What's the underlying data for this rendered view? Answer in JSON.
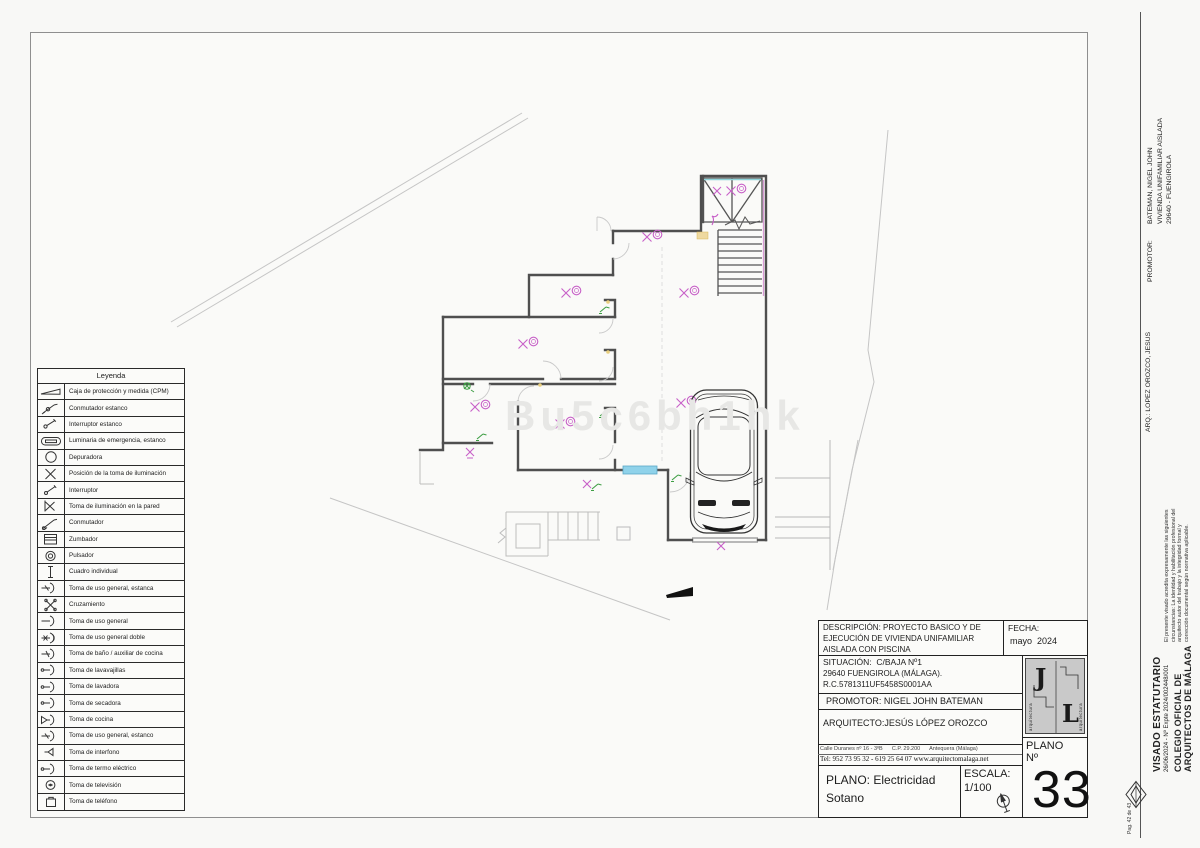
{
  "colors": {
    "wall": "#4f4f4f",
    "magenta": "#c75fc7",
    "green": "#3f9f45",
    "yellow": "#e9cf7e",
    "cyan": "#8fd2ea",
    "site": "#c2c2c2"
  },
  "watermark": "Bu5c6bh1hk",
  "legend": {
    "title": "Leyenda",
    "items": [
      {
        "icon": "cpm-wedge-icon",
        "label": "Caja de protección y medida (CPM)"
      },
      {
        "icon": "conmutador-estanco-icon",
        "label": "Conmutador estanco"
      },
      {
        "icon": "interruptor-estanco-icon",
        "label": "Interruptor estanco"
      },
      {
        "icon": "luminaria-emergencia-icon",
        "label": "Luminaria de emergencia, estanco"
      },
      {
        "icon": "depuradora-icon",
        "label": "Depuradora"
      },
      {
        "icon": "toma-iluminacion-icon",
        "label": "Posición de la toma de iluminación"
      },
      {
        "icon": "interruptor-icon",
        "label": "Interruptor"
      },
      {
        "icon": "toma-iluminacion-pared-icon",
        "label": "Toma de iluminación en la pared"
      },
      {
        "icon": "conmutador-icon",
        "label": "Conmutador"
      },
      {
        "icon": "zumbador-icon",
        "label": "Zumbador"
      },
      {
        "icon": "pulsador-icon",
        "label": "Pulsador"
      },
      {
        "icon": "cuadro-individual-icon",
        "label": "Cuadro individual"
      },
      {
        "icon": "toma-uso-general-estanco-icon",
        "label": "Toma de uso general, estanca"
      },
      {
        "icon": "cruzamiento-icon",
        "label": "Cruzamiento"
      },
      {
        "icon": "toma-uso-general-icon",
        "label": "Toma de uso general"
      },
      {
        "icon": "toma-uso-general-doble-icon",
        "label": "Toma de uso general doble"
      },
      {
        "icon": "toma-bano-icon",
        "label": "Toma de baño / auxiliar de cocina"
      },
      {
        "icon": "toma-lavavajillas-icon",
        "label": "Toma de lavavajillas"
      },
      {
        "icon": "toma-lavadora-icon",
        "label": "Toma de lavadora"
      },
      {
        "icon": "toma-secadora-icon",
        "label": "Toma de secadora"
      },
      {
        "icon": "toma-cocina-icon",
        "label": "Toma de cocina"
      },
      {
        "icon": "toma-uso-general-estanco2-icon",
        "label": "Toma de uso general, estanco"
      },
      {
        "icon": "toma-interfono-icon",
        "label": "Toma de interfono"
      },
      {
        "icon": "toma-termo-icon",
        "label": "Toma de termo eléctrico"
      },
      {
        "icon": "toma-television-icon",
        "label": "Toma de televisión"
      },
      {
        "icon": "toma-telefono-icon",
        "label": "Toma de teléfono"
      }
    ]
  },
  "title_block": {
    "descripcion_lines": [
      "DESCRIPCIÓN: PROYECTO BASICO Y DE",
      "EJECUCIÓN DE VIVIENDA UNIFAMILIAR",
      "AISLADA CON PISCINA"
    ],
    "fecha_label": "FECHA:",
    "fecha_value": "mayo  2024",
    "situacion_line1": "SITUACIÓN:  C/BAJA Nº1",
    "situacion_line2": "29640 FUENGIROLA (MÁLAGA).",
    "situacion_line3": "R.C.5781311UF5458S0001AA",
    "promotor": "PROMOTOR: NIGEL JOHN BATEMAN",
    "arquitecto": "ARQUITECTO:JESÚS LÓPEZ OROZCO",
    "address_line1": "Calle Duranes nº 16 - 3ºB      C.P. 29.200      Antequera (Málaga)",
    "address_line2": "Tel: 952 73 95 32 - 619 25 64 07 www.arquitectomalaga.net",
    "plano_label": "PLANO: Electricidad",
    "plano_label2": "Sotano",
    "escala_label": "ESCALA:",
    "escala_value": "1/100",
    "plano_no_label": "PLANO",
    "no_label": "Nº",
    "plano_number": "33",
    "logo_letter_j": "J",
    "logo_letter_l": "L",
    "logo_side_text": "arquitectura"
  },
  "sidebar": {
    "promotor_label": "PROMOTOR:",
    "promotor_lines": [
      "BATEMAN, NIGEL JOHN",
      "VIVIENDA UNIFAMILIAR AISLADA",
      "29640 - FUENGIROLA"
    ],
    "arq_line": "ARQ.: LOPEZ OROZCO, JESUS",
    "visado_note": "El presente visado acredita expresamente las siguientes circunstancias: La identidad y habilitación profesional del arquitecto autor del trabajo y la integridad formal y corrección documental según normativa aplicable.",
    "visado_title": "VISADO ESTATUTARIO",
    "visado_expte": "26/06/2024 - Nº Expte 2024/002448/001",
    "colegio_line1": "COLEGIO OFICIAL DE",
    "colegio_line2": "ARQUITECTOS DE MÁLAGA",
    "page_note": "Pag. 42 de 43"
  }
}
